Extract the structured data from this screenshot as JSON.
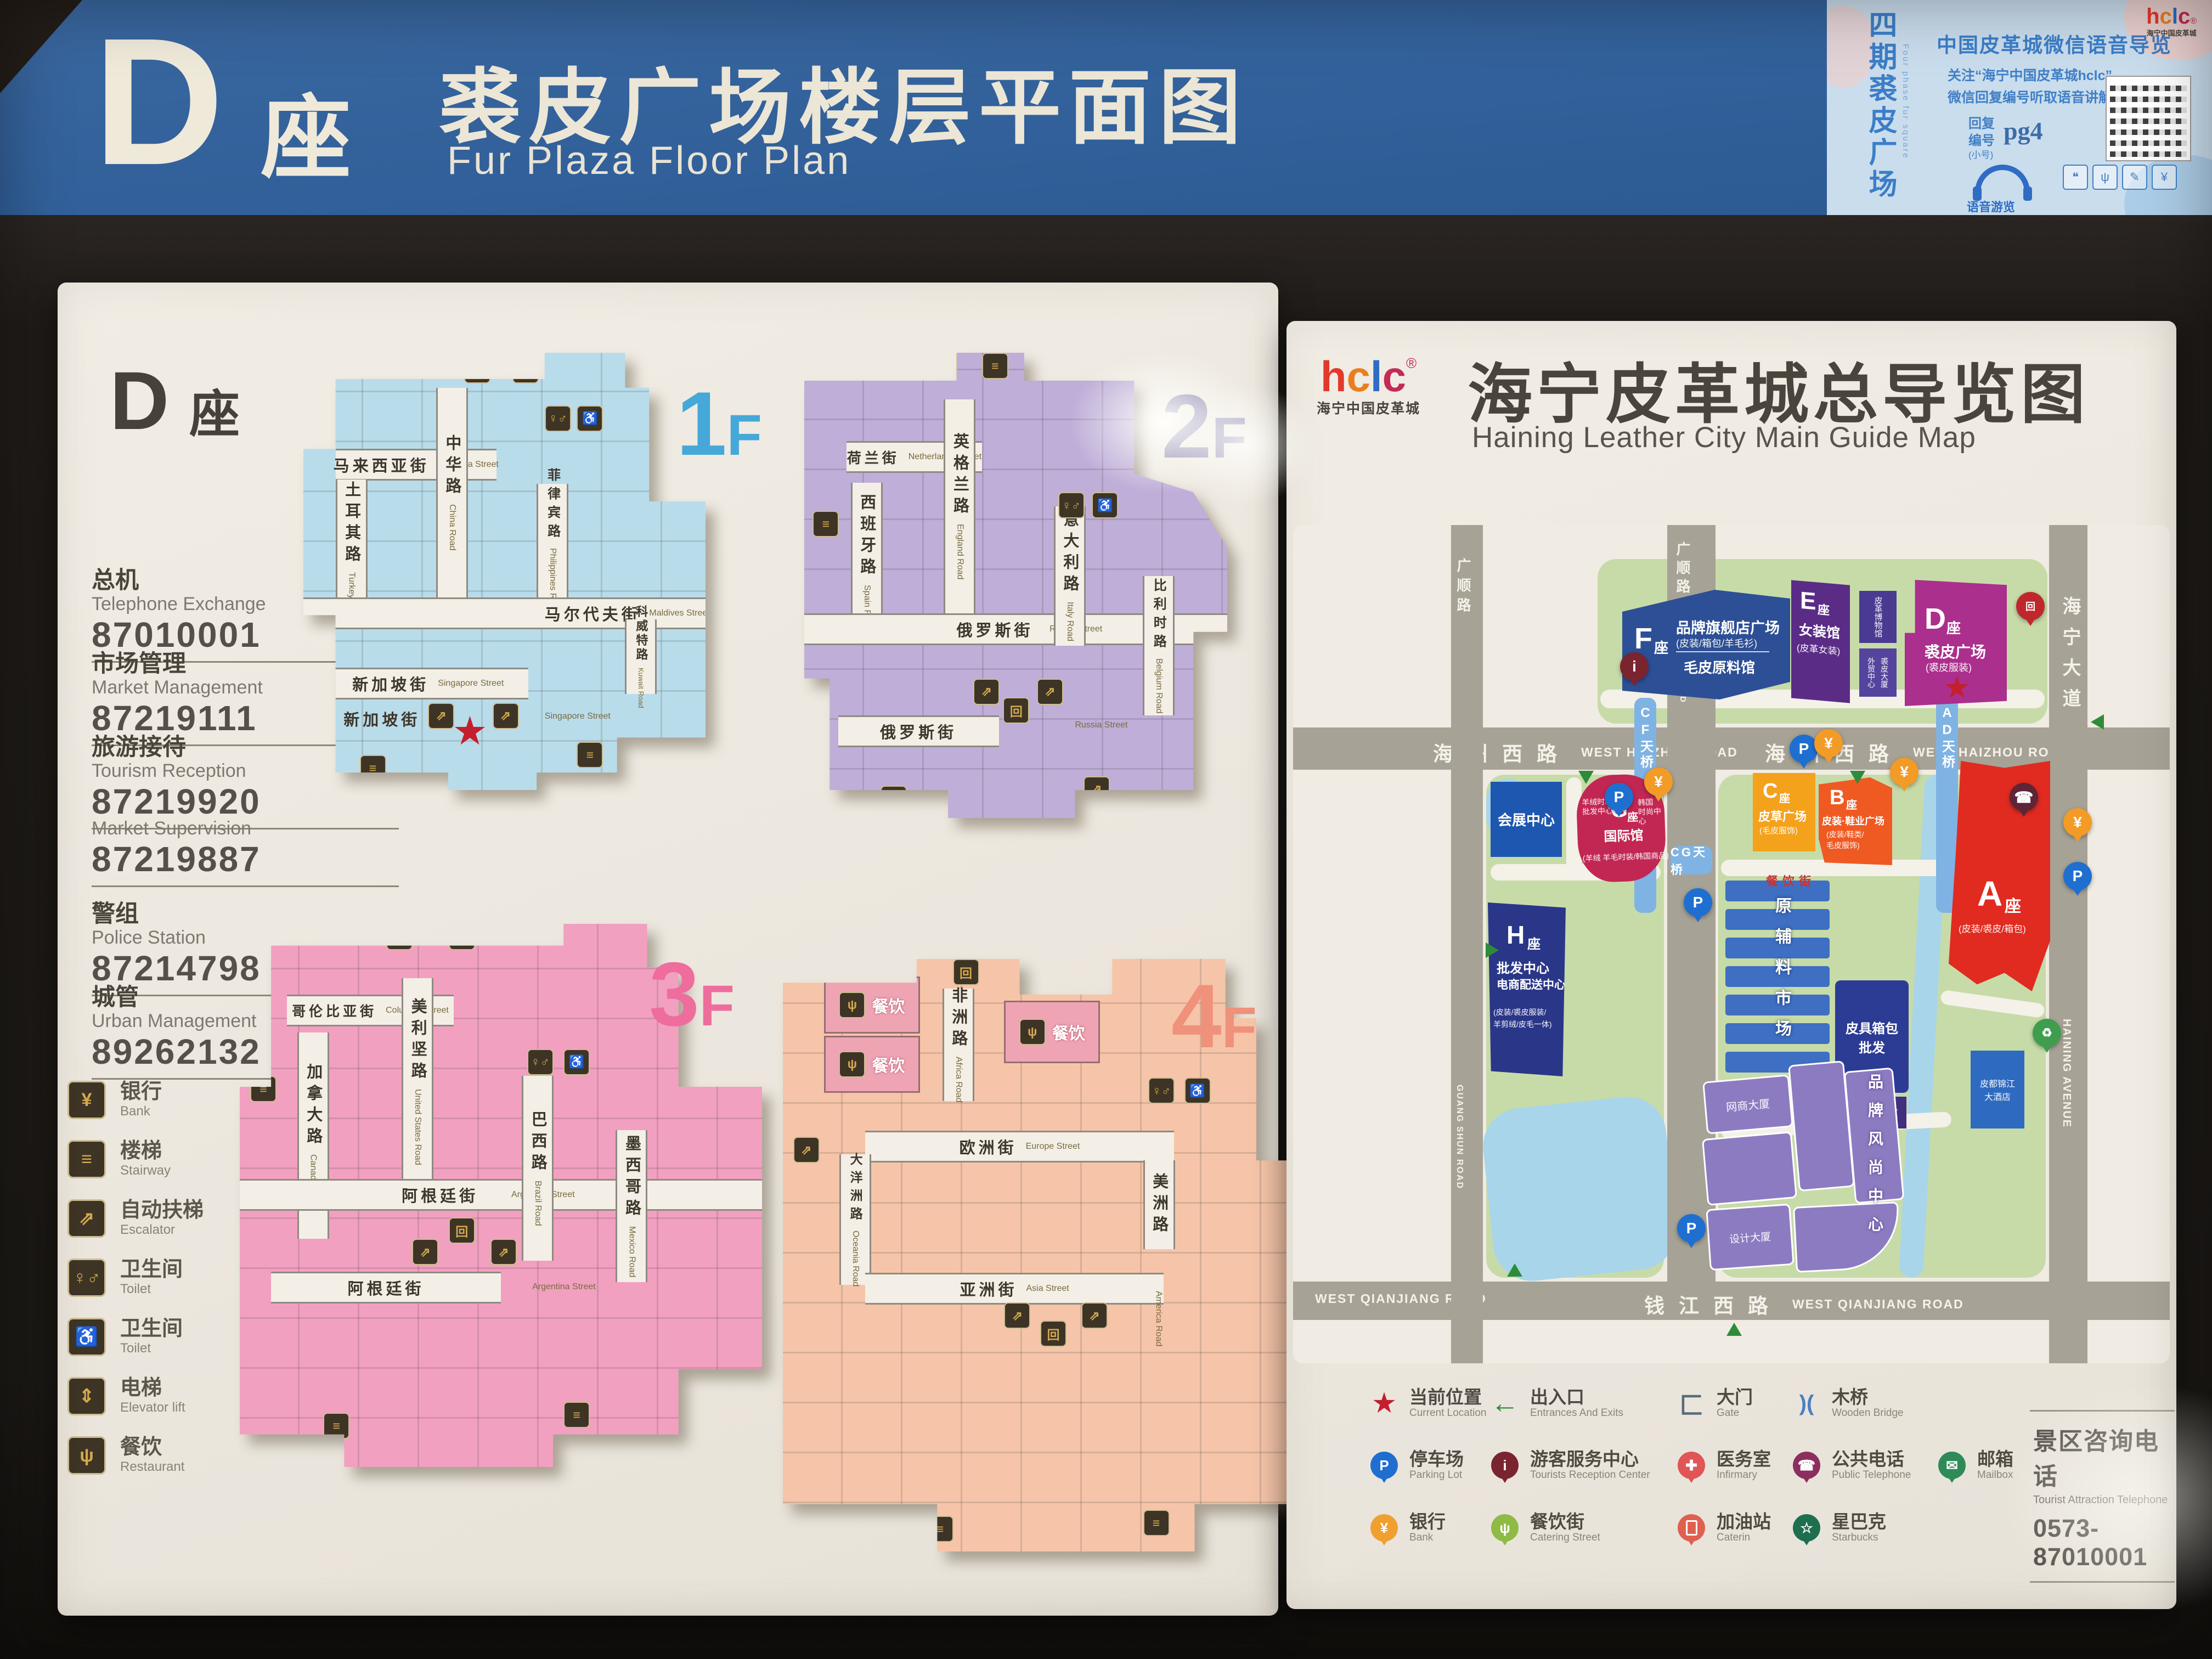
{
  "colors": {
    "banner_blue": "#31609a",
    "f1": "#45a8d8",
    "f2": "#8b84ae",
    "f3": "#ee6d9d",
    "f4": "#f0917c",
    "star_red": "#c41f2e",
    "bld_a_red": "#e12b20",
    "bld_d_magenta": "#ab2f8d"
  },
  "banner": {
    "letter": "D",
    "suffix": "座",
    "title": "裘皮广场楼层平面图",
    "subtitle": "Fur Plaza  Floor Plan"
  },
  "info_card": {
    "vertical_title": "四期裘皮广场",
    "vertical_subtitle": "Four phase fur square",
    "logo": "hclc",
    "logo_reg": "®",
    "logo_sub": "海宁中国皮革城",
    "heading": "中国皮革城微信语音导览",
    "line1": "关注“海宁中国皮革城hclc”",
    "line2": "微信回复编号听取语音讲解",
    "reply_label1": "回复",
    "reply_label2": "编号",
    "reply_code": "pg4",
    "reply_note": "(小号)",
    "audio_caption": "语音游览"
  },
  "left_panel": {
    "header": {
      "letter": "D",
      "suffix": "座"
    },
    "contacts": [
      {
        "zh": "总机",
        "en": "Telephone Exchange",
        "tel": "87010001"
      },
      {
        "zh": "市场管理",
        "en": "Market Management",
        "tel": "87219111"
      },
      {
        "zh": "旅游接待",
        "en": "Tourism Reception",
        "tel": "87219920"
      },
      {
        "zh": "市场监管",
        "en": "Market Supervision",
        "tel": "87219887"
      },
      {
        "zh": "警组",
        "en": "Police Station",
        "tel": "87214798"
      },
      {
        "zh": "城管",
        "en": "Urban Management",
        "tel": "89262132"
      }
    ],
    "legend": [
      {
        "zh": "银行",
        "en": "Bank",
        "icon": "yen"
      },
      {
        "zh": "楼梯",
        "en": "Stairway",
        "icon": "stairs"
      },
      {
        "zh": "自动扶梯",
        "en": "Escalator",
        "icon": "escalator"
      },
      {
        "zh": "卫生间",
        "en": "Toilet",
        "icon": "toilet"
      },
      {
        "zh": "卫生间",
        "en": "Toilet",
        "icon": "accessible-toilet"
      },
      {
        "zh": "电梯",
        "en": "Elevator lift",
        "icon": "elevator"
      },
      {
        "zh": "餐饮",
        "en": "Restaurant",
        "icon": "restaurant"
      }
    ],
    "floors": [
      {
        "num": "1",
        "suffix": "F",
        "streets": [
          {
            "zh": "马来西亚街",
            "en": "Malaysia Street"
          },
          {
            "zh": "土耳其路",
            "en": "Turkey Road"
          },
          {
            "zh": "中华路",
            "en": "China Road"
          },
          {
            "zh": "菲律宾路",
            "en": "Philippines Road"
          },
          {
            "zh": "马尔代夫街",
            "en": "Maldives Street"
          },
          {
            "zh": "科威特路",
            "en": "Kuwait Road"
          },
          {
            "zh": "新加坡街",
            "en": "Singapore Street"
          },
          {
            "zh": "新加坡街",
            "en": "Singapore Street"
          }
        ]
      },
      {
        "num": "2",
        "suffix": "F",
        "streets": [
          {
            "zh": "荷兰街",
            "en": "Netherlands Street"
          },
          {
            "zh": "西班牙路",
            "en": "Spain Road"
          },
          {
            "zh": "英格兰路",
            "en": "England Road"
          },
          {
            "zh": "意大利路",
            "en": "Italy Road"
          },
          {
            "zh": "比利时路",
            "en": "Belgium Road"
          },
          {
            "zh": "俄罗斯街",
            "en": "Russia Street"
          },
          {
            "zh": "俄罗斯街",
            "en": "Russia Street"
          }
        ]
      },
      {
        "num": "3",
        "suffix": "F",
        "streets": [
          {
            "zh": "哥伦比亚街",
            "en": "Columbia Street"
          },
          {
            "zh": "加拿大路",
            "en": "Canada Road"
          },
          {
            "zh": "美利坚路",
            "en": "United States Road"
          },
          {
            "zh": "巴西路",
            "en": "Brazil Road"
          },
          {
            "zh": "墨西哥路",
            "en": "Mexico Road"
          },
          {
            "zh": "阿根廷街",
            "en": "Argentina Street"
          },
          {
            "zh": "阿根廷街",
            "en": "Argentina Street"
          }
        ]
      },
      {
        "num": "4",
        "suffix": "F",
        "restaurant": "餐饮",
        "streets": [
          {
            "zh": "非洲路",
            "en": "Africa Road"
          },
          {
            "zh": "欧洲街",
            "en": "Europe Street"
          },
          {
            "zh": "大洋洲路",
            "en": "Oceania Road"
          },
          {
            "zh": "亚洲街",
            "en": "Asia Street"
          },
          {
            "zh": "美洲路",
            "en": "America Road"
          }
        ]
      }
    ]
  },
  "right_panel": {
    "logo": "hclc",
    "logo_reg": "®",
    "logo_sub": "海宁中国皮革城",
    "title": "海宁皮革城总导览图",
    "subtitle": "Haining Leather City Main Guide Map",
    "north": "N",
    "map": {
      "roads": {
        "haizhou": {
          "zh": "海州西路",
          "en": "WEST HAIZHOU ROAD"
        },
        "qianjiang": {
          "zh": "钱江西路",
          "en": "WEST QIANJIANG ROAD"
        },
        "guangshun": {
          "zh": "广顺路",
          "en": "GUANG SHUN ROAD"
        },
        "haining": {
          "zh": "海宁大道",
          "en": "HAINING AVENUE"
        }
      },
      "bridges": {
        "cf": "CF天桥",
        "cg": "CG天桥",
        "ad": "AD天桥"
      },
      "buildings": {
        "f": {
          "letter": "F",
          "suffix": "座",
          "l1": "品牌旗舰店广场",
          "l2": "(皮装/箱包/羊毛衫)",
          "l3": "毛皮原料馆"
        },
        "e": {
          "letter": "E",
          "suffix": "座",
          "l1": "女装馆",
          "l2": "(皮革女装)"
        },
        "museum": {
          "l1": "皮革博物馆"
        },
        "trade": {
          "l1": "外贸中心",
          "l2": "裘皮大厦"
        },
        "d": {
          "letter": "D",
          "suffix": "座",
          "l1": "裘皮广场",
          "l2": "(裘皮服装)"
        },
        "expo": {
          "l1": "会展中心"
        },
        "g": {
          "letter": "G",
          "suffix": "座",
          "l1": "国际馆",
          "left1": "羊绒时装",
          "left2": "批发中心",
          "right1": "韩国",
          "right2": "时尚中心",
          "l2": "(羊绒 羊毛时装/韩国商品)"
        },
        "c": {
          "letter": "C",
          "suffix": "座",
          "l1": "皮草广场",
          "l2": "(毛皮服饰)"
        },
        "b": {
          "letter": "B",
          "suffix": "座",
          "l1": "皮装·鞋业广场",
          "l2": "(皮装/鞋类/",
          "l3": "毛皮服饰)"
        },
        "a": {
          "letter": "A",
          "suffix": "座",
          "l2": "(皮装/裘皮/箱包)"
        },
        "h": {
          "letter": "H",
          "suffix": "座",
          "l1": "批发中心",
          "l2": "电商配送中心",
          "l3": "(皮装/裘皮服装/",
          "l4": "羊剪绒/皮毛一体)"
        },
        "materials": {
          "l1": "原辅料市场"
        },
        "luggage": {
          "l1": "皮具箱包",
          "l2": "批发"
        },
        "tower": {
          "l1": "皮革城大厦"
        },
        "ecom": {
          "l1": "网商大厦"
        },
        "design": {
          "l1": "设计大厦"
        },
        "fashion": {
          "l1": "品牌风尚中心"
        },
        "hotel": {
          "l1": "皮都锦江",
          "l2": "大酒店"
        },
        "catering": {
          "l1": "餐饮街"
        }
      }
    },
    "legend": [
      {
        "zh": "当前位置",
        "en": "Current Location",
        "icon": "star"
      },
      {
        "zh": "出入口",
        "en": "Entrances And Exits",
        "icon": "arrow"
      },
      {
        "zh": "大门",
        "en": "Gate",
        "icon": "gate"
      },
      {
        "zh": "木桥",
        "en": "Wooden Bridge",
        "icon": "bridge"
      },
      {
        "zh": "停车场",
        "en": "Parking Lot",
        "icon": "parking"
      },
      {
        "zh": "游客服务中心",
        "en": "Tourists Reception Center",
        "icon": "info"
      },
      {
        "zh": "医务室",
        "en": "Infirmary",
        "icon": "infirmary"
      },
      {
        "zh": "公共电话",
        "en": "Public Telephone",
        "icon": "phone"
      },
      {
        "zh": "邮箱",
        "en": "Mailbox",
        "icon": "mailbox"
      },
      {
        "zh": "银行",
        "en": "Bank",
        "icon": "bank"
      },
      {
        "zh": "餐饮街",
        "en": "Catering Street",
        "icon": "catering"
      },
      {
        "zh": "加油站",
        "en": "Caterin",
        "icon": "gas"
      },
      {
        "zh": "星巴克",
        "en": "Starbucks",
        "icon": "starbucks"
      }
    ],
    "hotline": {
      "zh": "景区咨询电话",
      "en": "Tourist Attraction Telephone",
      "tel": "0573-87010001"
    }
  }
}
